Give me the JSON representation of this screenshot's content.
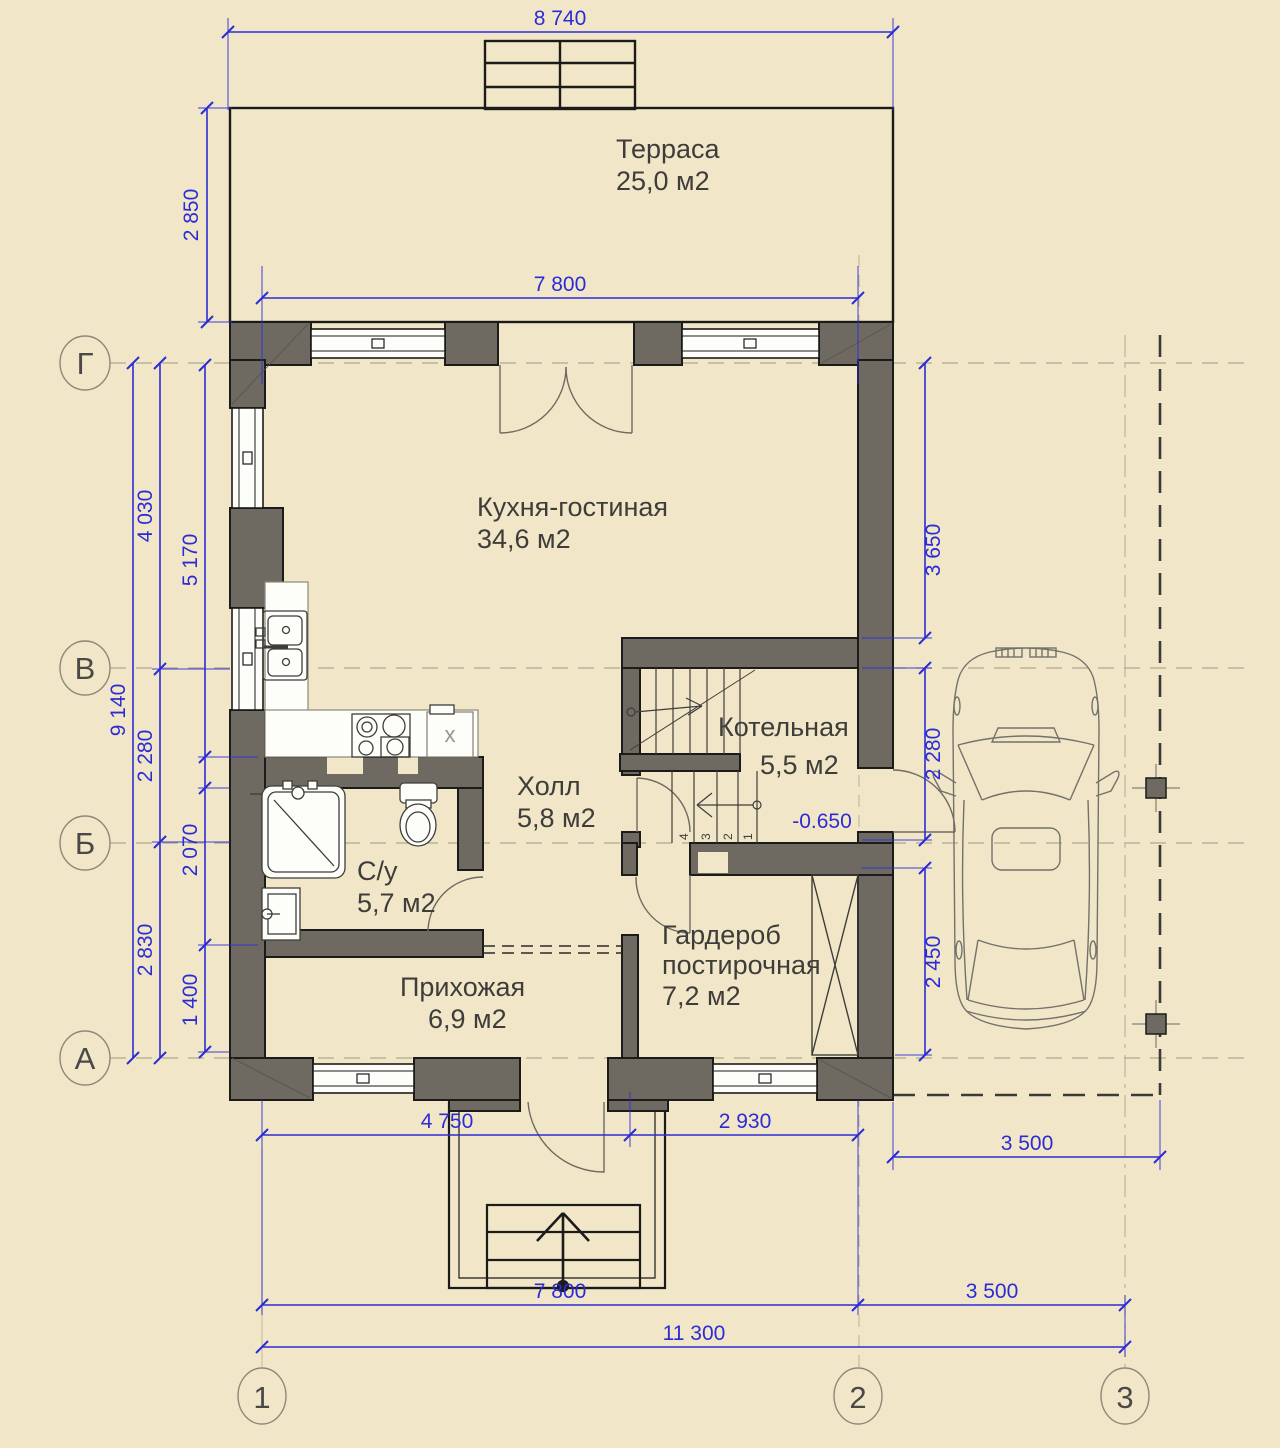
{
  "palette": {
    "background": "#f1e7c8",
    "wall_fill": "#6e6a62",
    "outline": "#1b1b19",
    "dimension_blue": "#2c2cd6",
    "label_gray": "#3e3d3a",
    "fixture_white": "#fdfdfa",
    "axis_gray": "#8f8878"
  },
  "rooms": {
    "terrace": {
      "name": "Терраса",
      "area": "25,0 м2"
    },
    "kitchen_living": {
      "name": "Кухня-гостиная",
      "area": "34,6 м2"
    },
    "boiler": {
      "name": "Котельная",
      "area": "5,5 м2"
    },
    "hall": {
      "name": "Холл",
      "area": "5,8 м2"
    },
    "bathroom": {
      "name": "С/у",
      "area": "5,7 м2"
    },
    "wardrobe": {
      "name": "Гардероб",
      "name2": "постирочная",
      "area": "7,2 м2"
    },
    "entry": {
      "name": "Прихожая",
      "area": "6,9 м2"
    }
  },
  "dimensions": {
    "top_width": "8 740",
    "terrace_depth": "2 850",
    "terrace_front": "7 800",
    "left_total": "9 140",
    "axis_g_v": "4 030",
    "axis_v_b": "2 280",
    "axis_b_a": "2 830",
    "room_kitchen_h": "5 170",
    "room_bath_h": "2 070",
    "room_entry_h": "1 400",
    "right_kitchen": "3 650",
    "right_boiler": "2 280",
    "right_wardrobe": "2 450",
    "bottom_left": "4 750",
    "bottom_right": "2 930",
    "carport_width": "3 500",
    "span_1_2": "7 800",
    "span_2_3": "3 500",
    "total_width": "11 300"
  },
  "marks": {
    "level": "-0.650",
    "appliance": "х"
  },
  "grid_axes": {
    "rows": [
      "Г",
      "В",
      "Б",
      "А"
    ],
    "cols": [
      "1",
      "2",
      "3"
    ]
  },
  "stairs": {
    "numbers": [
      "4",
      "3",
      "2",
      "1"
    ]
  }
}
